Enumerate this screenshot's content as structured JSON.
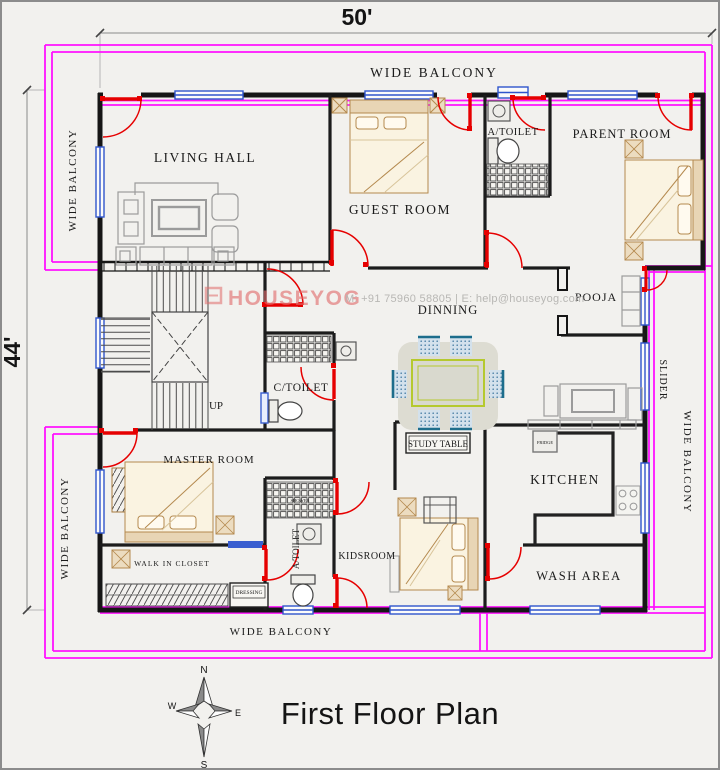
{
  "title": "First Floor Plan",
  "dimensions": {
    "width_label": "50'",
    "height_label": "44'"
  },
  "balcony_labels": {
    "top": "WIDE BALCONY",
    "left_upper": "WIDE BALCONY",
    "left_lower": "WIDE BALCONY",
    "bottom": "WIDE BALCONY",
    "right": "WIDE BALCONY",
    "slider": "SLIDER"
  },
  "rooms": {
    "living_hall": "LIVING HALL",
    "guest_room": "GUEST ROOM",
    "a_toilet_top": "A/TOILET",
    "parent_room": "PARENT ROOM",
    "pooja": "POOJA",
    "dinning": "DINNING",
    "c_toilet": "C/TOILET",
    "up": "UP",
    "master_room": "MASTER ROOM",
    "walk_in_closet": "WALK IN CLOSET",
    "dressing": "DRESSING",
    "a_toilet_bottom": "A/TOILET",
    "kidsroom": "KIDSROOM",
    "study_table": "STUDY TABLE",
    "kitchen": "KITCHEN",
    "wash_area": "WASH AREA",
    "fridge": "FRIDGE",
    "shower": "SHOWER"
  },
  "watermark": {
    "brand": "HOUSEYOG",
    "contact": "M: +91 75960 58805   |   E: help@houseyog.com"
  },
  "compass": {
    "north": "N",
    "south": "S",
    "east": "E",
    "west": "W"
  },
  "colors": {
    "background": "#f2f1ee",
    "balcony_outline": "#ff12ff",
    "wall": "#161616",
    "window": "#2f55cc",
    "door": "#e60000",
    "furniture_wood": "#b4894e",
    "dining_table_edge": "#b5c92e",
    "watermark_brand": "#e06a6a"
  }
}
